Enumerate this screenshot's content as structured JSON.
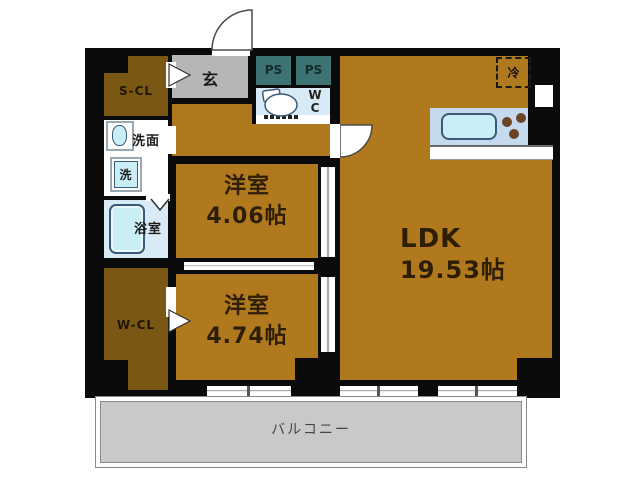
{
  "title": "apartment-floorplan",
  "colors": {
    "wall": "#0b0b0b",
    "room": "#b0791e",
    "closet": "#7a5813",
    "genkan": "#b6b6b6",
    "ps": "#3d7373",
    "waterblue": "#d9eaf7",
    "fixture": "#c9eef6",
    "fixture-outline": "#3a5a78",
    "counter": "#c6daee",
    "burner": "#6b4423",
    "balcony": "#c9c9c9",
    "text-dark": "#2e1e06"
  },
  "rooms": {
    "scl": {
      "label": "S-CL"
    },
    "genkan": {
      "label": "玄"
    },
    "ps1": {
      "label": "PS"
    },
    "ps2": {
      "label": "PS"
    },
    "wc": {
      "line1": "W",
      "line2": "C"
    },
    "senmen": {
      "label": "洗面"
    },
    "washer": {
      "label": "洗"
    },
    "bath": {
      "label": "浴室"
    },
    "wcl": {
      "label": "W-CL"
    },
    "western1": {
      "label": "洋室",
      "area": "4.06帖"
    },
    "western2": {
      "label": "洋室",
      "area": "4.74帖"
    },
    "ldk": {
      "label": "LDK",
      "area": "19.53帖"
    },
    "balcony": {
      "label": "バルコニー"
    },
    "fridge": {
      "label": "冷"
    }
  },
  "icons": [
    "toilet-icon",
    "washbasin-icon",
    "washing-machine-icon",
    "bathtub-icon",
    "kitchen-sink-icon",
    "stove-burners-icon",
    "refrigerator-dashed-box",
    "entrance-door-arc-icon",
    "ldk-door-arc-icon",
    "folding-door-icon",
    "entry-arrow-icon",
    "closet-arrow-icon"
  ]
}
